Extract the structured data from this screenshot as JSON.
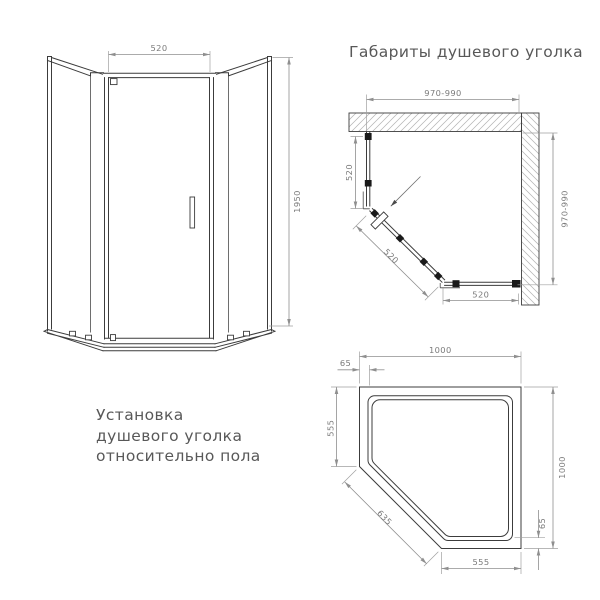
{
  "title": "Габариты душевого уголка",
  "install_note": {
    "line1": "Установка",
    "line2": "душевого уголка",
    "line3": "относительно пола"
  },
  "front_view": {
    "door_width": "520",
    "height": "1950"
  },
  "corner_view": {
    "opening_top": "970-990",
    "opening_side": "970-990",
    "left_panel": "520",
    "door": "520",
    "bottom_panel": "520"
  },
  "tray_view": {
    "width_top": "1000",
    "depth_right": "1000",
    "side_left": "555",
    "side_bottom": "555",
    "diagonal": "635",
    "rim_offset_top": "65",
    "rim_offset_right": "65"
  },
  "colors": {
    "outline": "#3c3c3c",
    "dimension": "#8f8f8f",
    "text": "#585858",
    "clamp": "#1a1a1a",
    "background": "#ffffff"
  }
}
